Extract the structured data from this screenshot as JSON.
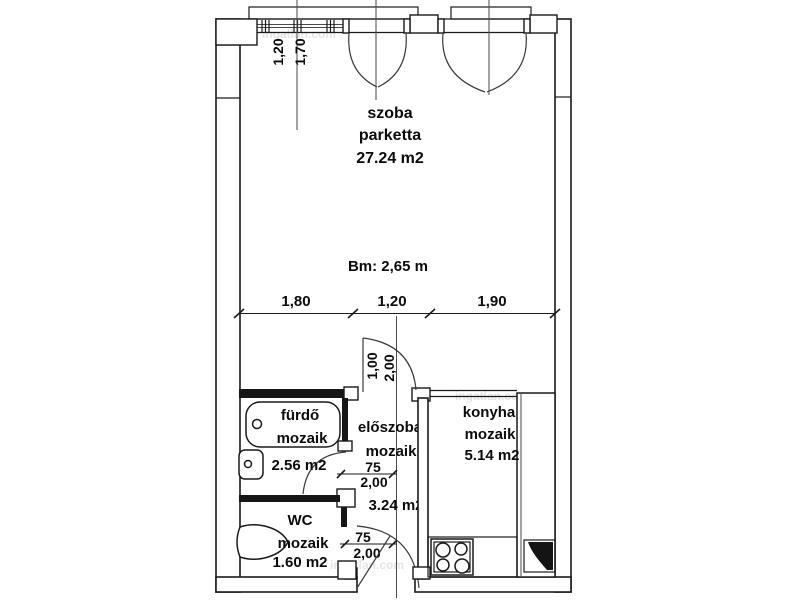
{
  "plan": {
    "rooms": {
      "szoba": {
        "name": "szoba",
        "floor": "parketta",
        "area": "27.24 m2"
      },
      "furdo": {
        "name": "fürdő",
        "floor": "mozaik",
        "area": "2.56 m2"
      },
      "eloszoba": {
        "name": "előszoba",
        "floor": "mozaik",
        "area": "3.24 m2"
      },
      "konyha": {
        "name": "konyha",
        "floor": "mozaik",
        "area": "5.14 m2"
      },
      "wc": {
        "name": "WC",
        "floor": "mozaik",
        "area": "1.60 m2"
      }
    },
    "ceiling_height": "Bm: 2,65 m",
    "dims": {
      "top_window": {
        "a": "1,20",
        "b": "1,70"
      },
      "width": {
        "a": "1,80",
        "b": "1,20",
        "c": "1,90"
      },
      "szoba_door": {
        "w": "1,00",
        "h": "2,00"
      },
      "furdo_door": {
        "w": "75",
        "h": "2,00"
      },
      "wc_door": {
        "w": "75",
        "h": "2,00"
      }
    },
    "watermark": "ingatlan.com",
    "line_color": "#1a1a1a",
    "bg_color": "#ffffff"
  }
}
